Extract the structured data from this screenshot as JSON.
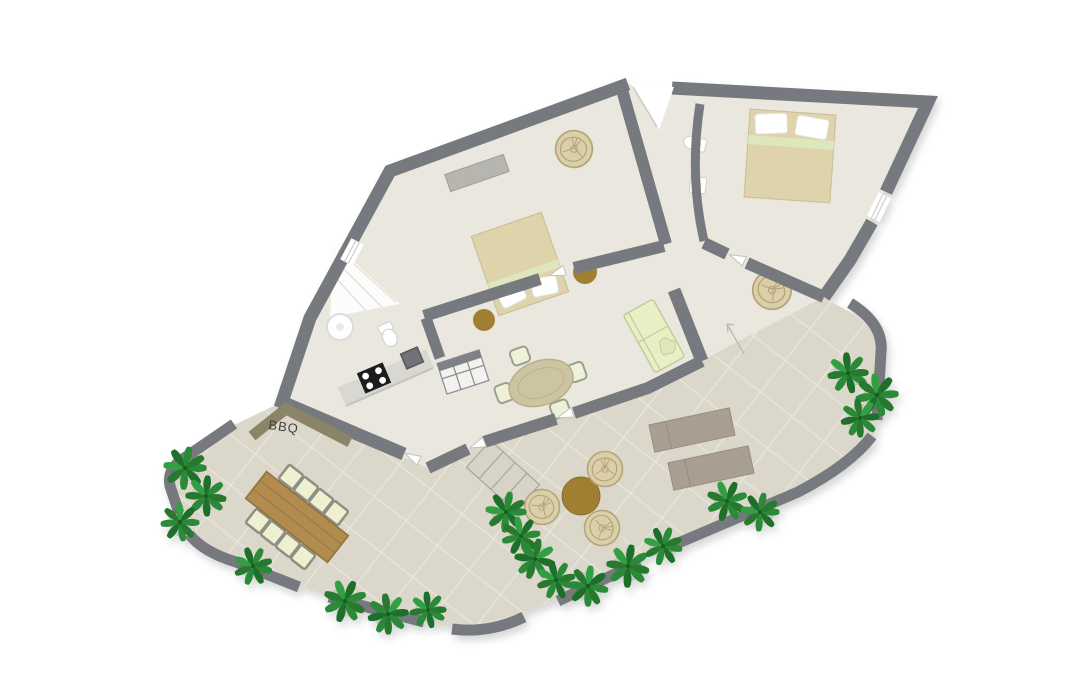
{
  "document": {
    "kind": "apartment-floor-plan",
    "view": "top-down-render"
  },
  "labels": {
    "bbq": "BBQ"
  },
  "colors": {
    "wall": "#76797e",
    "interior_floor": "#eae7de",
    "terrace_tile": "#dbd7ca",
    "tile_grout": "#e9e6db",
    "bed": "#ded3ab",
    "pillow": "#ffffff",
    "blanket_accent": "#dde6bd",
    "rattan": "#dbcfa8",
    "pouf_brown": "#a17f31",
    "wood_table": "#b28c50",
    "outdoor_chair_cushion": "#eef0cf",
    "sofa": "#e9efc4",
    "sun_lounger": "#a89f91",
    "plant_green": "#2c8a38",
    "bbq_counter": "#8b8468",
    "stove": "#222222",
    "background": "#ffffff"
  },
  "furniture_inventory": {
    "double_beds": 2,
    "rattan_chairs": 2,
    "rattan_poufs": 3,
    "brown_side_tables": 3,
    "coffee_table": 1,
    "sofa": 1,
    "indoor_dining_seats": 4,
    "outdoor_dining_seats": 8,
    "sun_loungers": 2,
    "plants": 19,
    "stove_burners": 4
  }
}
